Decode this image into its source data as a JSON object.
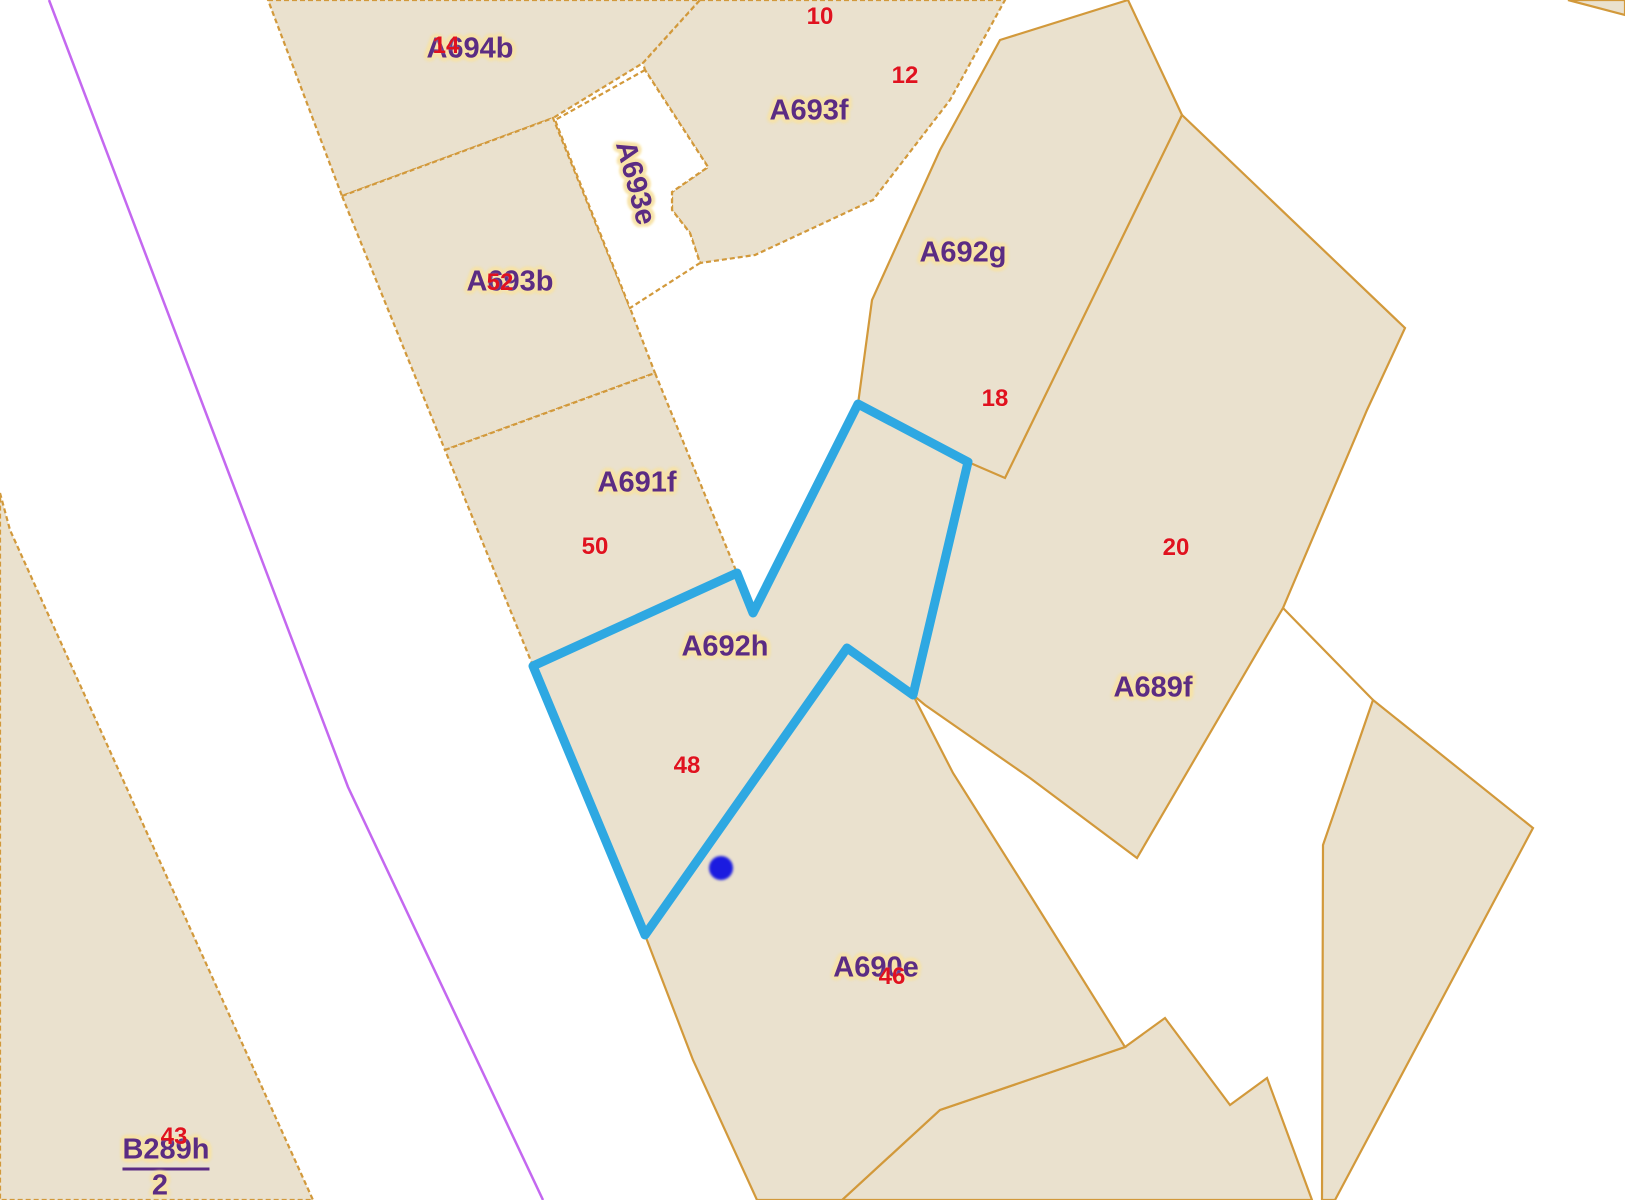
{
  "map": {
    "type": "cadastral-parcel-map",
    "canvas": {
      "width": 1625,
      "height": 1200,
      "background": "#ffffff"
    },
    "colors": {
      "parcel_fill": "#EAE1CE",
      "parcel_border": "#D2993B",
      "white_fill": "#ffffff",
      "parcel_label": "#5B2C83",
      "label_halo": "#F7E3A9",
      "number_label": "#E0121F",
      "selection_stroke": "#2EA8E2",
      "marker_fill": "#1B1BE0",
      "violet_line": "#C468F0"
    },
    "parcels": [
      {
        "id": "A694b",
        "dashed": true,
        "points": [
          [
            268,
            0
          ],
          [
            700,
            0
          ],
          [
            643,
            63
          ],
          [
            553,
            118
          ],
          [
            342,
            196
          ]
        ]
      },
      {
        "id": "A693b",
        "dashed": true,
        "points": [
          [
            342,
            196
          ],
          [
            553,
            118
          ],
          [
            630,
            308
          ],
          [
            655,
            373
          ],
          [
            445,
            450
          ]
        ]
      },
      {
        "id": "A691f",
        "dashed": true,
        "points": [
          [
            445,
            450
          ],
          [
            655,
            373
          ],
          [
            737,
            573
          ],
          [
            533,
            666
          ]
        ]
      },
      {
        "id": "A693f",
        "dashed": true,
        "points": [
          [
            700,
            0
          ],
          [
            1005,
            0
          ],
          [
            950,
            100
          ],
          [
            873,
            200
          ],
          [
            755,
            255
          ],
          [
            700,
            263
          ],
          [
            690,
            233
          ],
          [
            672,
            210
          ],
          [
            672,
            192
          ],
          [
            708,
            167
          ],
          [
            645,
            70
          ],
          [
            643,
            63
          ]
        ]
      },
      {
        "id": "A692g",
        "dashed": false,
        "points": [
          [
            1128,
            0
          ],
          [
            1182,
            115
          ],
          [
            1007,
            480
          ],
          [
            968,
            462
          ],
          [
            858,
            404
          ],
          [
            872,
            300
          ],
          [
            940,
            150
          ],
          [
            1000,
            40
          ]
        ]
      },
      {
        "id": "A689f",
        "dashed": false,
        "points": [
          [
            1182,
            115
          ],
          [
            1405,
            328
          ],
          [
            1367,
            410
          ],
          [
            1283,
            608
          ],
          [
            1137,
            858
          ],
          [
            1030,
            778
          ],
          [
            925,
            705
          ],
          [
            913,
            695
          ],
          [
            968,
            462
          ],
          [
            1005,
            478
          ]
        ]
      },
      {
        "id": "parcel-bottom-right",
        "dashed": false,
        "points": [
          [
            1373,
            700
          ],
          [
            1533,
            828
          ],
          [
            1335,
            1200
          ],
          [
            1322,
            1200
          ],
          [
            1323,
            845
          ]
        ]
      },
      {
        "id": "parcel-bottom-center",
        "dashed": false,
        "points": [
          [
            1165,
            1018
          ],
          [
            1230,
            1105
          ],
          [
            1267,
            1078
          ],
          [
            1312,
            1200
          ],
          [
            842,
            1200
          ],
          [
            940,
            1110
          ],
          [
            1125,
            1047
          ]
        ]
      },
      {
        "id": "A690e",
        "dashed": false,
        "points": [
          [
            645,
            935
          ],
          [
            847,
            648
          ],
          [
            913,
            695
          ],
          [
            953,
            773
          ],
          [
            1030,
            895
          ],
          [
            1125,
            1047
          ],
          [
            940,
            1110
          ],
          [
            842,
            1200
          ],
          [
            757,
            1200
          ],
          [
            693,
            1060
          ]
        ]
      },
      {
        "id": "A692h",
        "dashed": false,
        "points": [
          [
            858,
            404
          ],
          [
            968,
            462
          ],
          [
            913,
            695
          ],
          [
            847,
            648
          ],
          [
            645,
            935
          ],
          [
            533,
            666
          ],
          [
            737,
            573
          ],
          [
            753,
            613
          ]
        ]
      },
      {
        "id": "B289h",
        "dashed": true,
        "points": [
          [
            0,
            493
          ],
          [
            10,
            530
          ],
          [
            313,
            1200
          ],
          [
            0,
            1200
          ]
        ]
      },
      {
        "id": "parcel-top-right-sliver",
        "dashed": false,
        "points": [
          [
            1568,
            0
          ],
          [
            1625,
            0
          ],
          [
            1625,
            15
          ]
        ]
      }
    ],
    "white_cutouts": [
      {
        "id": "A693e",
        "dashed": true,
        "points": [
          [
            645,
            70
          ],
          [
            555,
            120
          ],
          [
            630,
            308
          ],
          [
            700,
            263
          ],
          [
            690,
            233
          ],
          [
            672,
            210
          ],
          [
            672,
            192
          ],
          [
            708,
            167
          ]
        ]
      }
    ],
    "extra_lines": [
      {
        "id": "violet-boundary",
        "color_key": "violet_line",
        "width": 2.5,
        "dashed": false,
        "points": [
          [
            49,
            0
          ],
          [
            220,
            450
          ],
          [
            348,
            787
          ],
          [
            543,
            1200
          ]
        ]
      },
      {
        "id": "orange-connector",
        "color_key": "parcel_border",
        "width": 2.2,
        "dashed": false,
        "points": [
          [
            1283,
            608
          ],
          [
            1373,
            700
          ]
        ]
      }
    ],
    "selection": {
      "id": "selected-parcel-A692h",
      "stroke_width": 9,
      "points": [
        [
          858,
          404
        ],
        [
          968,
          462
        ],
        [
          913,
          695
        ],
        [
          847,
          648
        ],
        [
          645,
          935
        ],
        [
          533,
          666
        ],
        [
          737,
          573
        ],
        [
          753,
          613
        ]
      ]
    },
    "marker": {
      "x": 721,
      "y": 868,
      "r": 12
    },
    "labels": [
      {
        "text": "A694b",
        "x": 470,
        "y": 49,
        "type": "parcel"
      },
      {
        "text": "A693f",
        "x": 809,
        "y": 111,
        "type": "parcel"
      },
      {
        "text": "A693e",
        "x": 635,
        "y": 183,
        "type": "parcel",
        "rotation": 75
      },
      {
        "text": "A692g",
        "x": 963,
        "y": 253,
        "type": "parcel"
      },
      {
        "text": "A693b",
        "x": 510,
        "y": 282,
        "type": "parcel"
      },
      {
        "text": "A691f",
        "x": 637,
        "y": 483,
        "type": "parcel"
      },
      {
        "text": "A692h",
        "x": 725,
        "y": 647,
        "type": "parcel"
      },
      {
        "text": "A689f",
        "x": 1153,
        "y": 688,
        "type": "parcel"
      },
      {
        "text": "A690e",
        "x": 876,
        "y": 968,
        "type": "parcel"
      },
      {
        "text": "B289h",
        "x": 166,
        "y": 1153,
        "type": "parcel",
        "underline": true
      },
      {
        "text": "2",
        "x": 160,
        "y": 1186,
        "type": "parcel"
      },
      {
        "text": "14",
        "x": 446,
        "y": 46,
        "type": "number"
      },
      {
        "text": "10",
        "x": 820,
        "y": 17,
        "type": "number"
      },
      {
        "text": "12",
        "x": 905,
        "y": 76,
        "type": "number"
      },
      {
        "text": "52",
        "x": 500,
        "y": 283,
        "type": "number"
      },
      {
        "text": "18",
        "x": 995,
        "y": 399,
        "type": "number"
      },
      {
        "text": "50",
        "x": 595,
        "y": 547,
        "type": "number"
      },
      {
        "text": "20",
        "x": 1176,
        "y": 548,
        "type": "number"
      },
      {
        "text": "48",
        "x": 687,
        "y": 766,
        "type": "number"
      },
      {
        "text": "46",
        "x": 892,
        "y": 977,
        "type": "number"
      },
      {
        "text": "43",
        "x": 174,
        "y": 1137,
        "type": "number"
      }
    ]
  }
}
